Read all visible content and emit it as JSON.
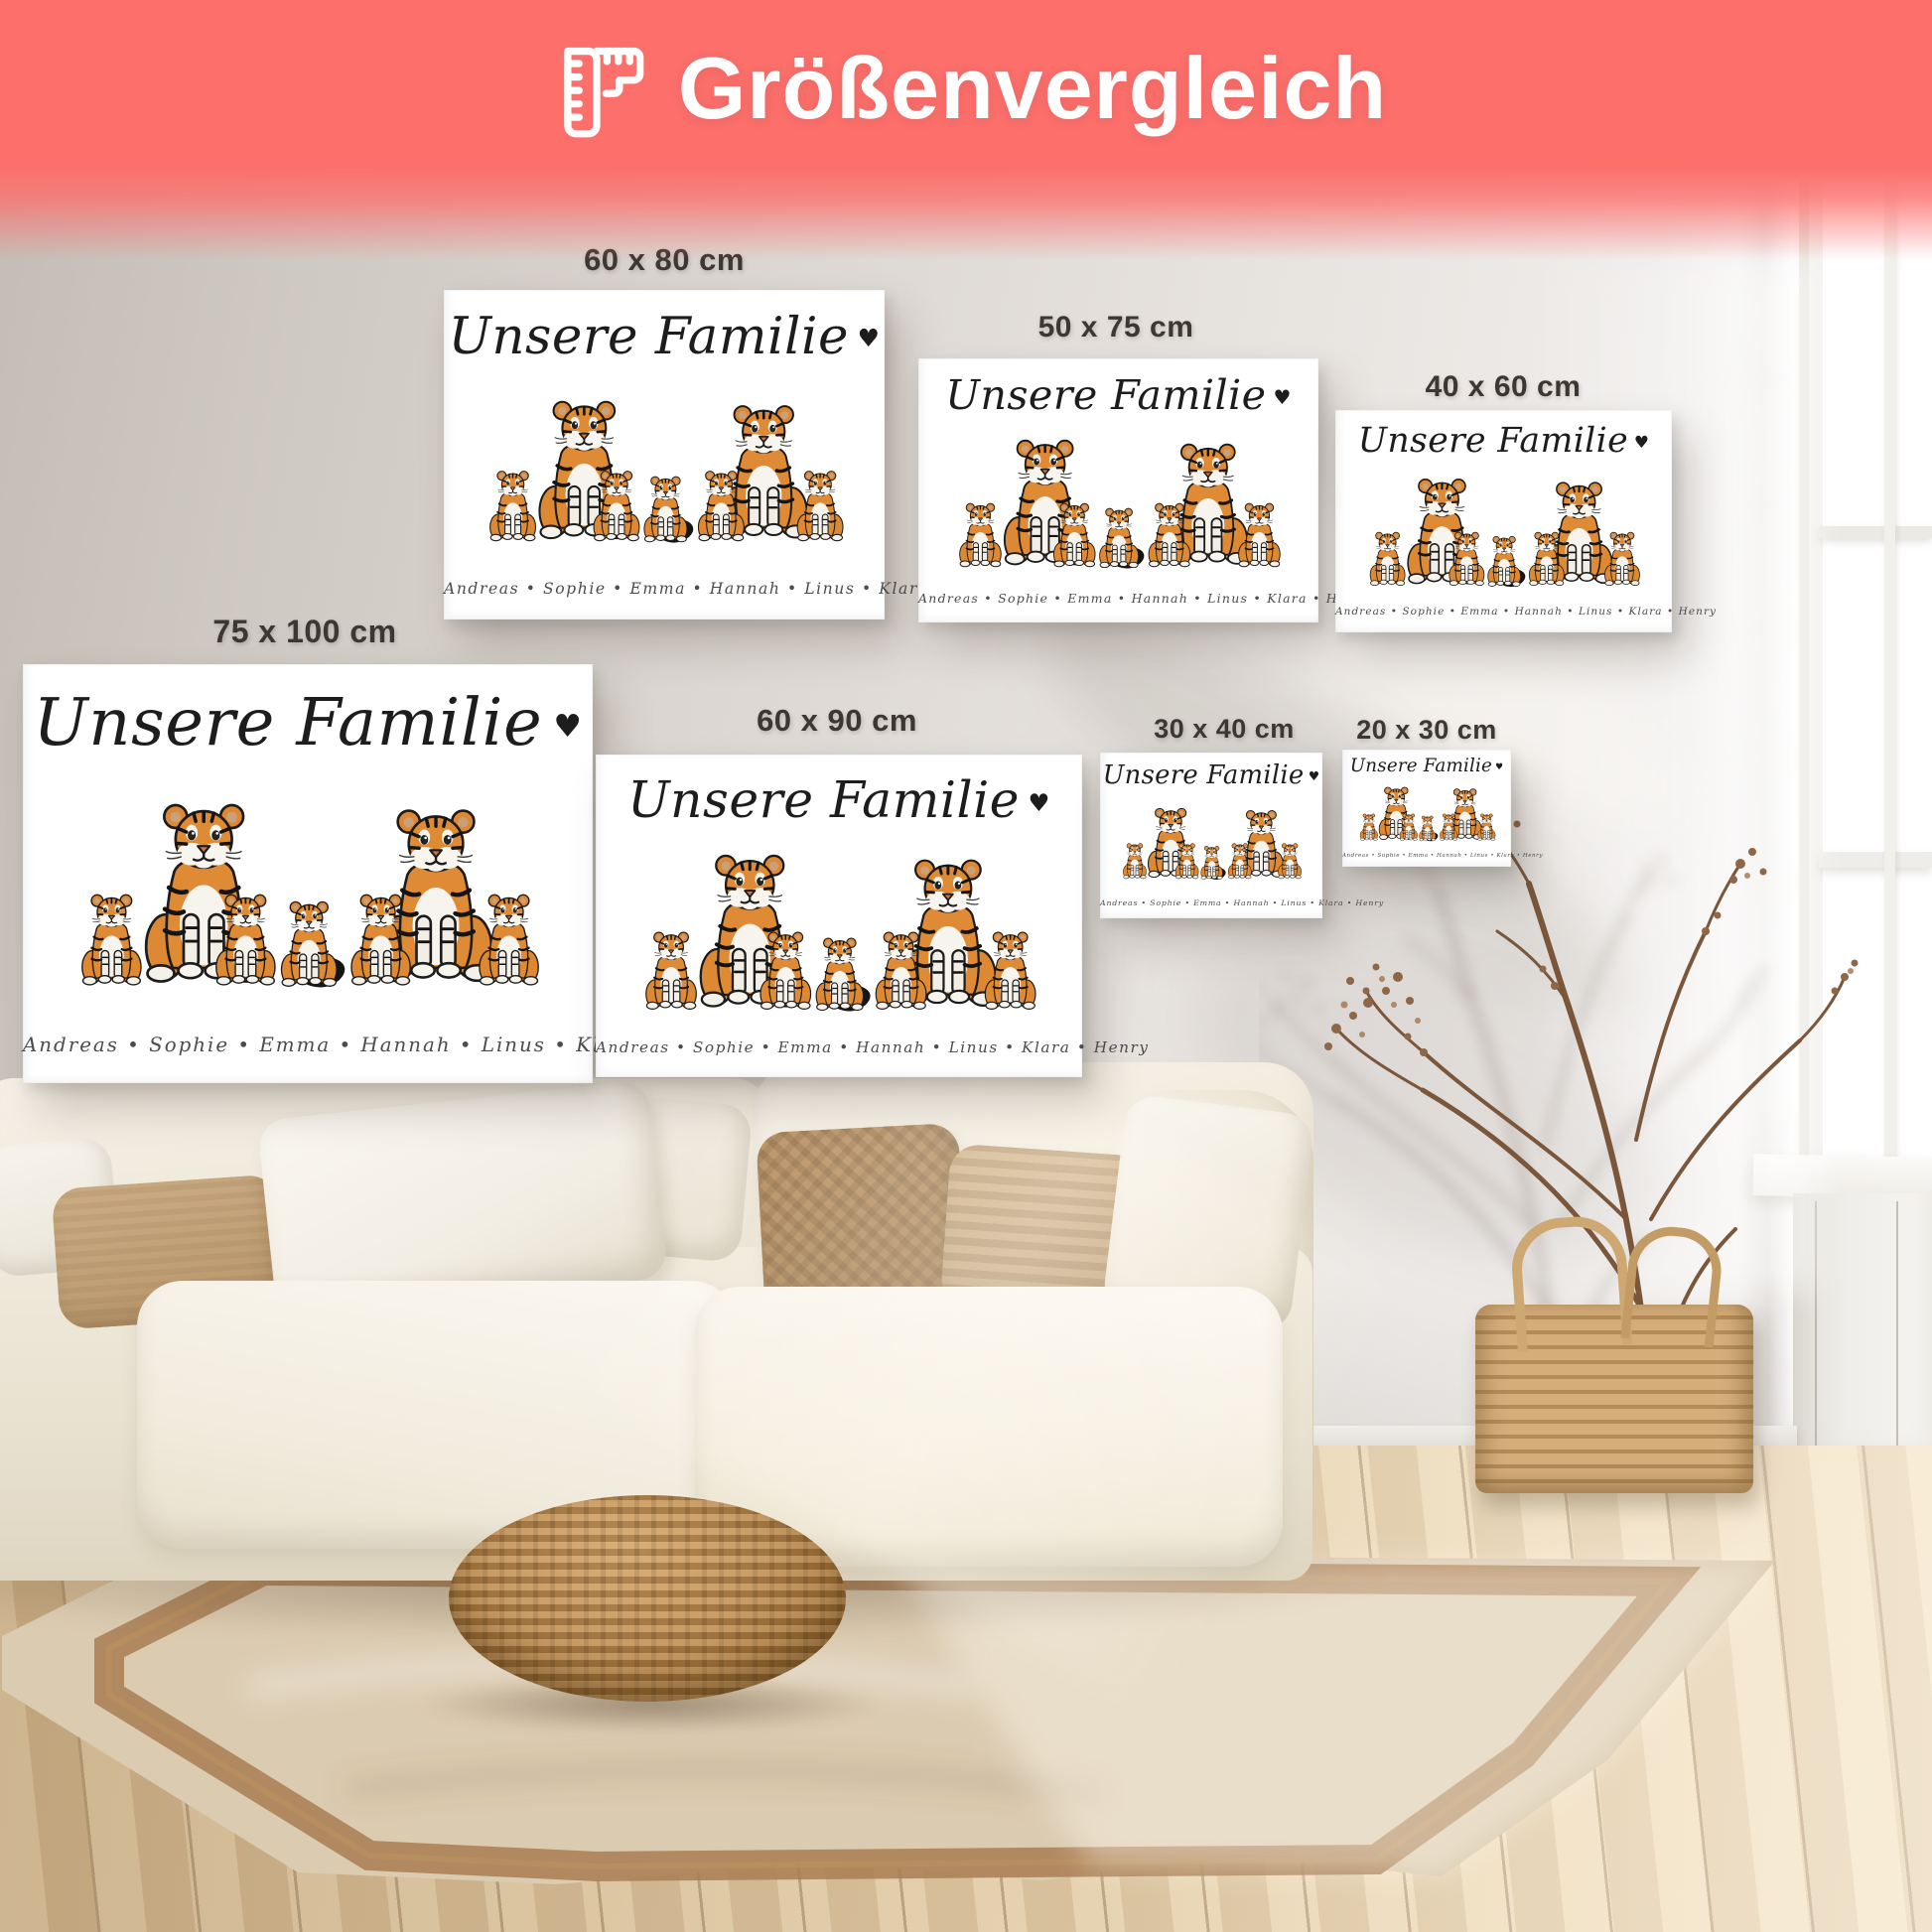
{
  "header": {
    "icon": "ruler-icon",
    "title": "Größenvergleich"
  },
  "poster": {
    "title": "Unsere Familie",
    "heart": "♥",
    "names": "Andreas • Sophie • Emma • Hannah • Linus • Klara • Henry",
    "illustration": "tiger-family"
  },
  "size_labels": [
    {
      "id": "60x80",
      "label": "60 x 80 cm"
    },
    {
      "id": "50x75",
      "label": "50 x 75 cm"
    },
    {
      "id": "40x60",
      "label": "40 x 60 cm"
    },
    {
      "id": "75x100",
      "label": "75 x 100 cm"
    },
    {
      "id": "60x90",
      "label": "60 x 90 cm"
    },
    {
      "id": "30x40",
      "label": "30 x 40 cm"
    },
    {
      "id": "20x30",
      "label": "20 x 30 cm"
    }
  ],
  "palette": {
    "banner": "#fc6f6b",
    "banner_text": "#ffffff",
    "size_label_text": "#3c3733",
    "poster_background": "#ffffff",
    "script_ink": "#1d1d1d",
    "tiger_orange": "#df8a35",
    "wall": "#dcd7d2",
    "sofa_cream": "#f2ecdf",
    "rug_beige": "#dbcbb1",
    "rug_border": "#a87e52",
    "wood_floor": "#dcc6a4"
  }
}
